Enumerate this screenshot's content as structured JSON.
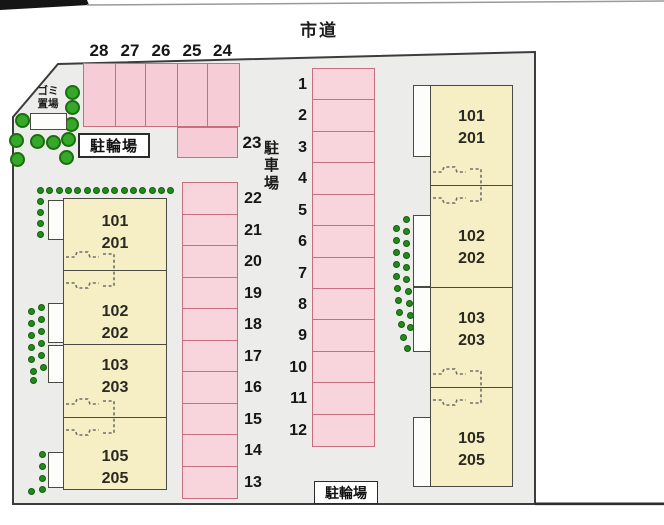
{
  "labels": {
    "road": "市道",
    "parking_lot": "駐車場",
    "bicycle_parking_top": "駐輪場",
    "bicycle_parking_bottom": "駐輪場",
    "garbage_line1": "ゴミ",
    "garbage_line2": "置場"
  },
  "parking": {
    "top_row": [
      "28",
      "27",
      "26",
      "25",
      "24"
    ],
    "side_space": "23",
    "middle_column": [
      "22",
      "21",
      "20",
      "19",
      "18",
      "17",
      "16",
      "15",
      "14",
      "13"
    ],
    "right_column": [
      "1",
      "2",
      "3",
      "4",
      "5",
      "6",
      "7",
      "8",
      "9",
      "10",
      "11",
      "12"
    ]
  },
  "buildings": {
    "left": {
      "units": [
        {
          "upper": "101",
          "lower": "201"
        },
        {
          "upper": "102",
          "lower": "202"
        },
        {
          "upper": "103",
          "lower": "203"
        },
        {
          "upper": "105",
          "lower": "205"
        }
      ]
    },
    "right": {
      "units": [
        {
          "upper": "101",
          "lower": "201"
        },
        {
          "upper": "102",
          "lower": "202"
        },
        {
          "upper": "103",
          "lower": "203"
        },
        {
          "upper": "105",
          "lower": "205"
        }
      ]
    }
  },
  "colors": {
    "site_fill": "#ececea",
    "site_border": "#3c3c3c",
    "parking_fill": "#f8d4dd",
    "parking_fill_top": "#f6ccd6",
    "parking_border": "#c96e7e",
    "building_fill": "#f6efc5",
    "tree_green": "#35a82a",
    "tree_green_dark": "#1f8c1a"
  }
}
